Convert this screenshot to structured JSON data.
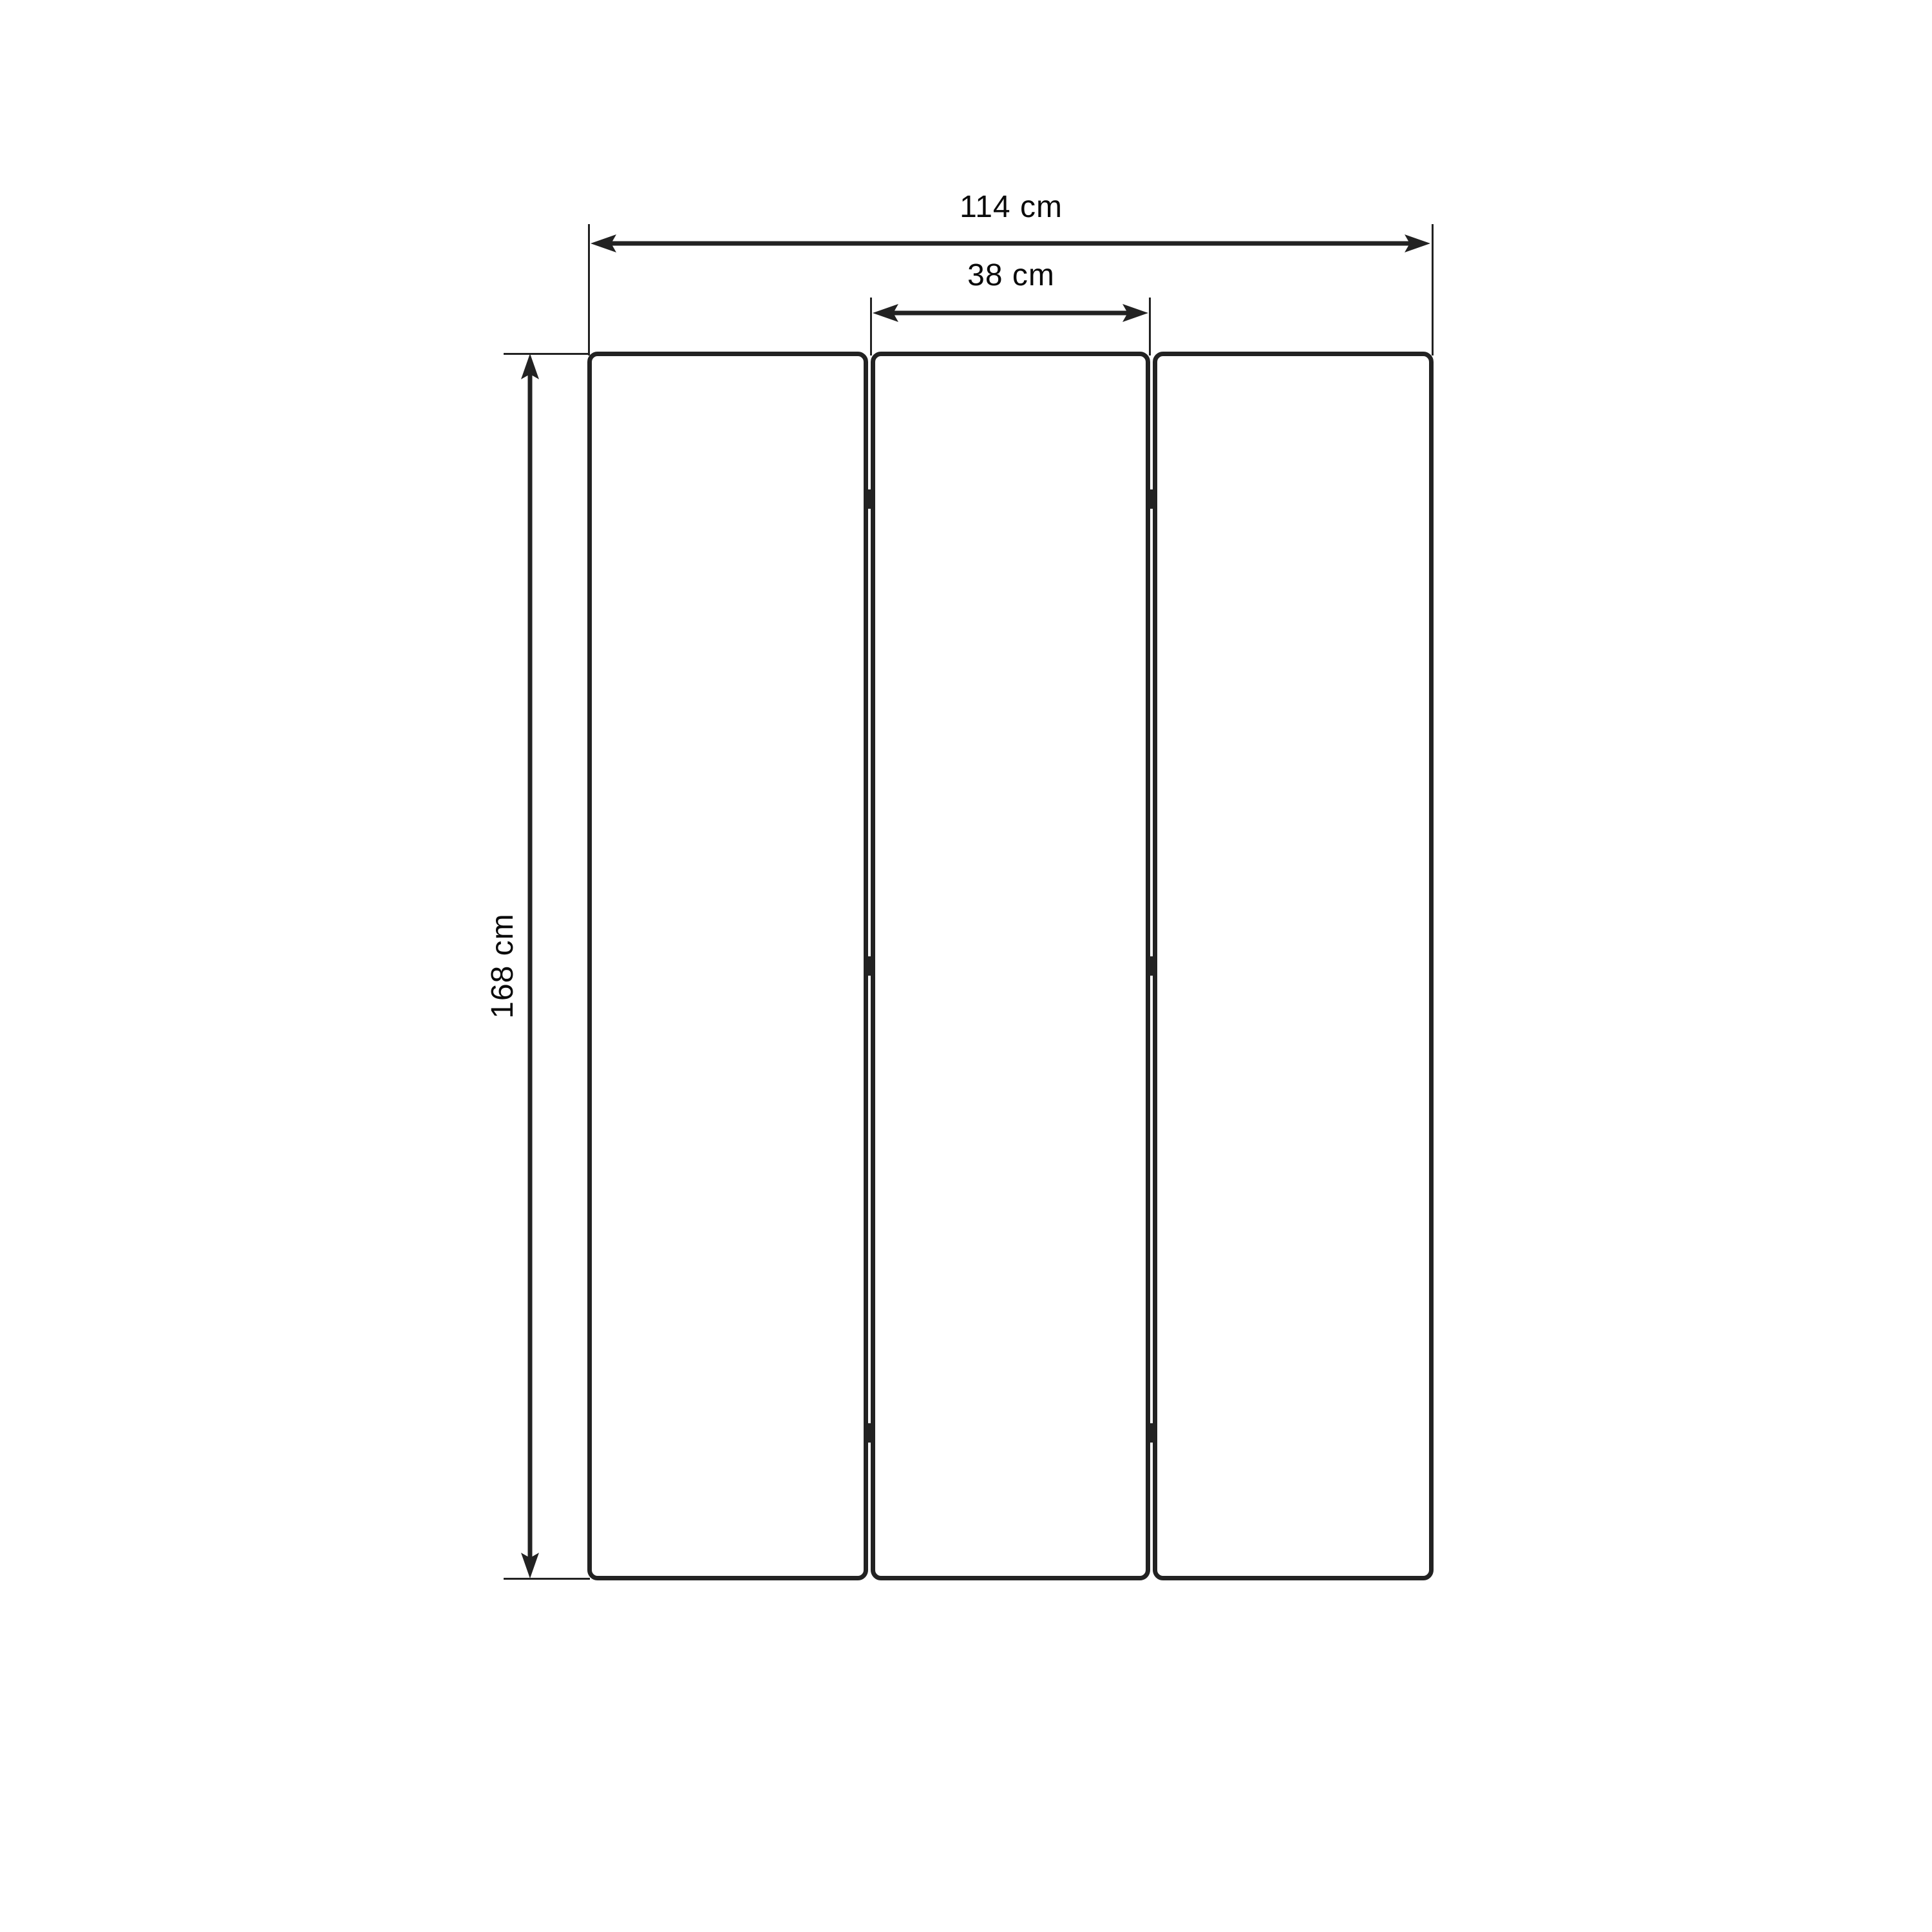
{
  "diagram": {
    "kind": "furniture-dimension-drawing",
    "subject": "three-panel folding screen, front elevation",
    "background_color": "#ffffff",
    "line_color": "#222222",
    "text_color": "#0a0a0a",
    "panels": {
      "count": 3,
      "hinges_per_gap": 3
    },
    "dimensions": {
      "total_width": {
        "label": "114 cm",
        "value": 114,
        "unit": "cm"
      },
      "panel_width": {
        "label": "38 cm",
        "value": 38,
        "unit": "cm"
      },
      "height": {
        "label": "168 cm",
        "value": 168,
        "unit": "cm"
      }
    }
  }
}
